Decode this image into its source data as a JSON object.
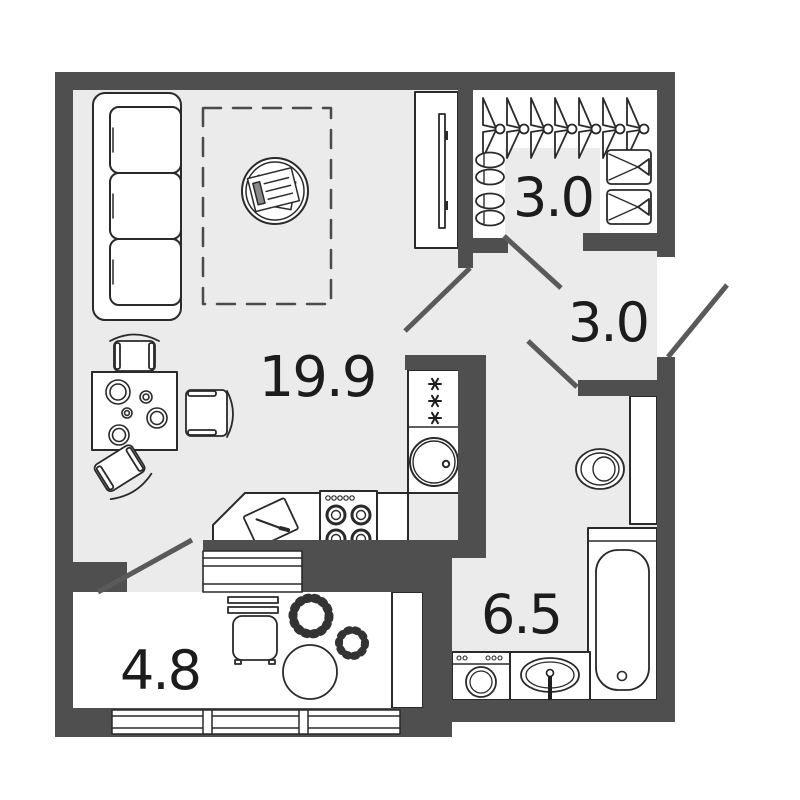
{
  "plan": {
    "type": "apartment-floor-plan",
    "rooms": {
      "living_room": {
        "name": "living-room-kitchen",
        "area": "19.9"
      },
      "wardrobe": {
        "name": "wardrobe",
        "area": "3.0"
      },
      "hallway": {
        "name": "hallway",
        "area": "3.0"
      },
      "bathroom": {
        "name": "bathroom",
        "area": "6.5"
      },
      "balcony": {
        "name": "balcony",
        "area": "4.8"
      }
    },
    "colors": {
      "wall": "#4f4f4f",
      "floor": "#ebebeb",
      "fixture_fill": "#ffffff",
      "outline": "#2a2a2a",
      "door_leaf": "#5a5a5a",
      "label": "#1c1c1c"
    },
    "fixtures": [
      "sofa",
      "furniture-zone",
      "coffee-table-magazines",
      "tv-stand",
      "dining-table",
      "chairs",
      "fridge",
      "kitchen-sink",
      "stove",
      "countertop-cutting-board",
      "hangers",
      "slippers",
      "storage-boxes",
      "toilet",
      "cistern-panel",
      "bathtub",
      "washing-machine",
      "bathroom-sink",
      "stool",
      "plants",
      "round-table",
      "balcony-cabinet",
      "balcony-windows"
    ]
  }
}
